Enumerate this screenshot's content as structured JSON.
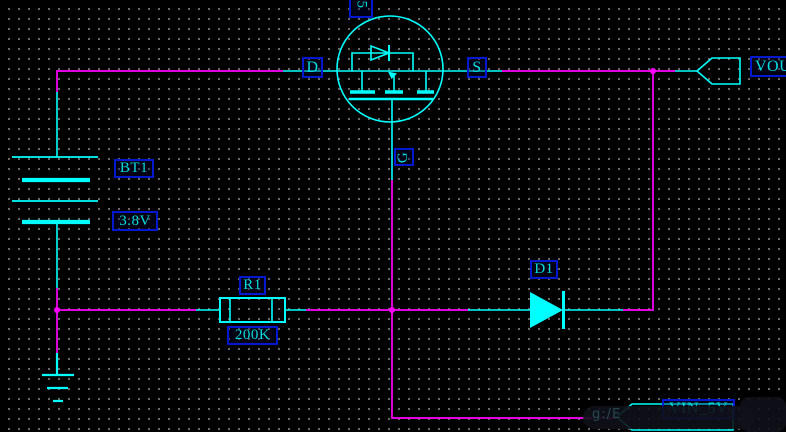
{
  "window": {
    "width": 786,
    "height": 432,
    "background": "#000000"
  },
  "grid": {
    "dot_color": "#7d7d7d",
    "spacing_px": 10
  },
  "colors": {
    "wire": "#ff00ff",
    "component": "#00ffff",
    "label_text": "#00dede",
    "label_border": "#0019d0",
    "junction": "#ff00ff"
  },
  "schematic": {
    "battery": {
      "designator": "BT1",
      "value": "3.8V"
    },
    "resistor": {
      "designator": "R1",
      "value": "200K"
    },
    "diode": {
      "designator": "D1"
    },
    "mosfet": {
      "pin_drain": "D",
      "pin_source": "S",
      "pin_gate": "G",
      "top_partial_label": "5"
    },
    "ports": {
      "output": "VOUT",
      "input": "VIN_5V"
    }
  },
  "watermark": {
    "fragment": "g:/E"
  }
}
